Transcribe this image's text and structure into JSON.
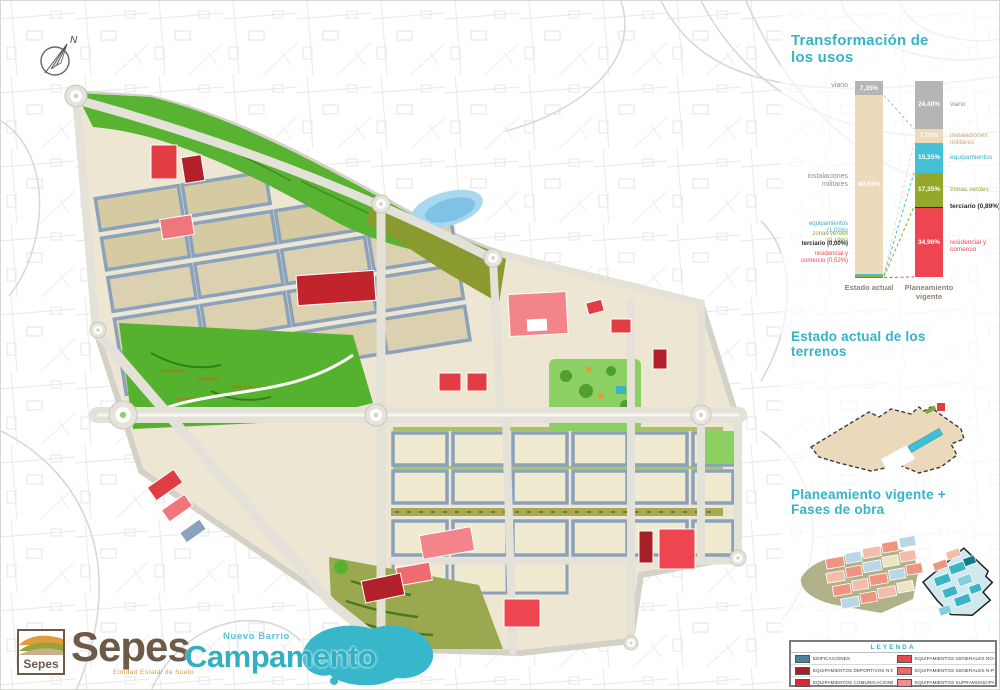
{
  "header": {
    "compass_north": "N"
  },
  "branding": {
    "sepes_logo_text": "Sepes",
    "sepes_wordmark": "Sepes",
    "sepes_tagline": "Entidad Estatal de Suelo",
    "project_overline": "Nuevo Barrio",
    "project_wordmark": "Campamento"
  },
  "panels": {
    "transformation": {
      "title": "Transformación de los usos"
    },
    "estado": {
      "title": "Estado actual de los terrenos"
    },
    "planeamiento": {
      "title": "Planeamiento vigente + Fases de obra"
    },
    "legend": {
      "title": "LEYENDA",
      "items": [
        {
          "label": "EDIFICACIONES",
          "color": "#4e7f9b"
        },
        {
          "label": "EQUIPAMIENTOS DEPORTIVOS N-D",
          "color": "#a61e26"
        },
        {
          "label": "EQUIPAMIENTOS COMUNICACIONES ST",
          "color": "#d92b33"
        },
        {
          "label": "EQUIPAMIENTOS GENERALES NO-CS",
          "color": "#e04b50"
        },
        {
          "label": "EQUIPAMIENTOS GENERALES N-P",
          "color": "#e86a6e"
        },
        {
          "label": "EQUIPAMIENTOS SUPRAMUNICIPALES N-SP",
          "color": "#ef8d8f"
        }
      ]
    }
  },
  "chart_data": {
    "type": "bar",
    "subtype": "stacked-100-percent",
    "title": "Transformación de los usos",
    "categories": [
      "Estado actual",
      "Planeamiento vigente"
    ],
    "unit": "%",
    "grid": false,
    "legend_position": "side-labels",
    "series": [
      {
        "name": "viario",
        "color": "#b5b5b3",
        "label_color": "#8f8f8d",
        "values": [
          7.35,
          24.4
        ],
        "bar_labels": [
          "7,35%",
          "24,40%"
        ],
        "left_label": "viario",
        "right_label": "viario"
      },
      {
        "name": "instalaciones militares",
        "color": "#ecdabb",
        "label_color": "#c9a87c",
        "values": [
          90.92,
          7.01
        ],
        "bar_labels": [
          "90,92%",
          "7,01%"
        ],
        "left_label": "instalaciones militares",
        "right_label": "instalaciones militares"
      },
      {
        "name": "equipamientos",
        "color": "#45c1d6",
        "label_color": "#38b0c4",
        "values": [
          1.02,
          15.35
        ],
        "bar_labels": [
          null,
          "15,35%"
        ],
        "left_label": "equipamientos (1,02%)",
        "right_label": "equipamientos"
      },
      {
        "name": "zonas verdes",
        "color": "#94a92b",
        "label_color": "#94a92b",
        "values": [
          0.19,
          17.35
        ],
        "bar_labels": [
          null,
          "17,35%"
        ],
        "left_label": "zonas verdes (0,19%)",
        "right_label": "zonas verdes"
      },
      {
        "name": "terciario",
        "color": "#2b2b2b",
        "label_color": "#2b2b2b",
        "values": [
          0.0,
          0.89
        ],
        "bar_labels": [
          null,
          null
        ],
        "left_label": "terciario (0,00%)",
        "right_label": "terciario (0,89%)"
      },
      {
        "name": "residencial y comercio",
        "color": "#ee4550",
        "label_color": "#ee4550",
        "values": [
          0.52,
          34.96
        ],
        "bar_labels": [
          null,
          "34,96%"
        ],
        "left_label": "residencial y comercio (0,52%)",
        "right_label": "residencial y comercio"
      }
    ]
  }
}
